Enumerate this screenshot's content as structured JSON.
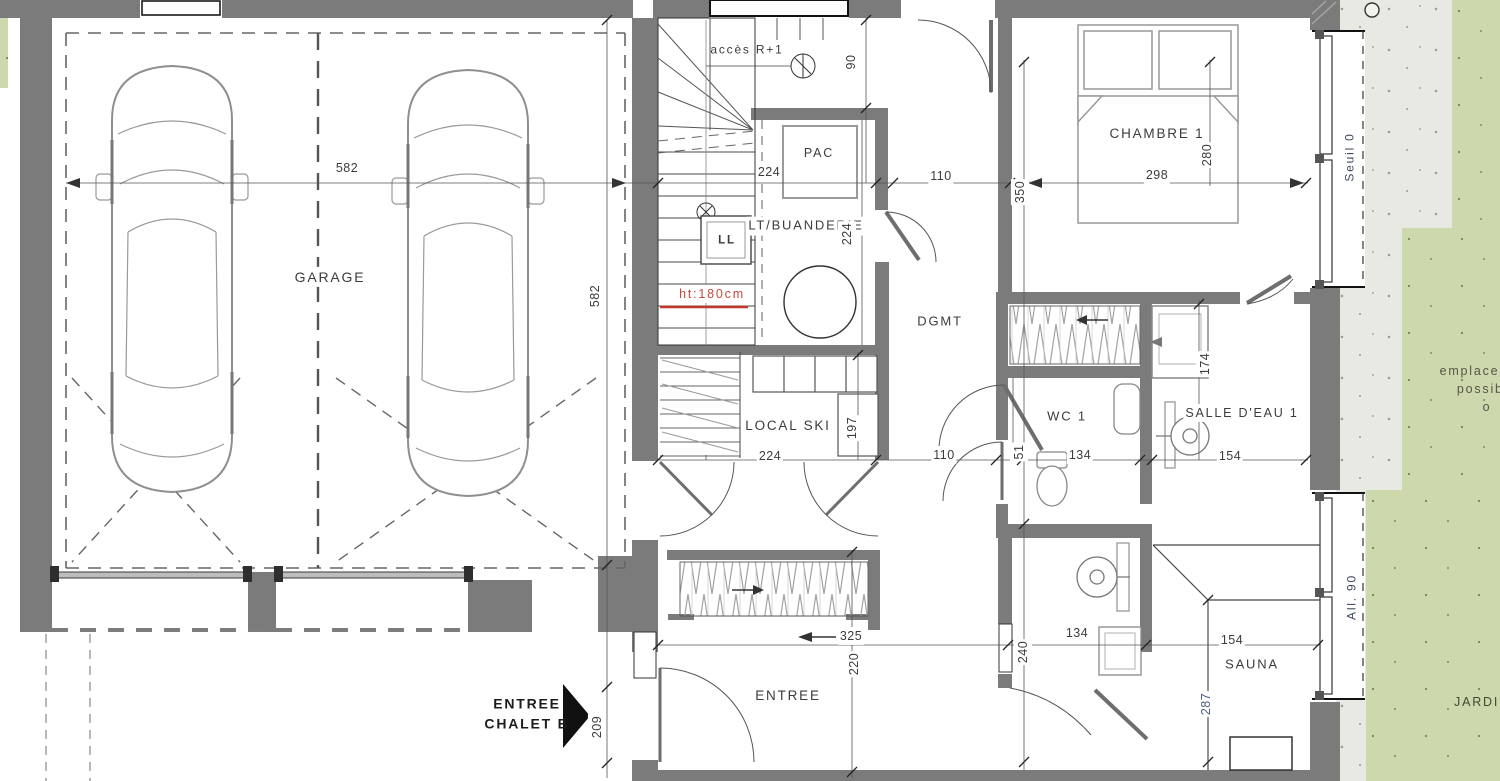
{
  "plan_title": "Chalet B - niveau garage",
  "colors": {
    "wall": "#7b7b7b",
    "green_jardin": "#cdd9ac",
    "gravel": "#e9e9e4",
    "red_note": "#c44a3d",
    "dim_text": "#3a3a3a",
    "window_label": "#3f4a5e"
  },
  "rooms": [
    {
      "name": "room-label-garage",
      "text": "GARAGE",
      "x": 330,
      "y": 277,
      "size": 14
    },
    {
      "name": "room-label-acces-r1",
      "text": "accès R+1",
      "x": 747,
      "y": 50,
      "size": 12,
      "cls": "nobg"
    },
    {
      "name": "room-label-pac",
      "text": "PAC",
      "x": 819,
      "y": 153,
      "size": 12.5,
      "cls": "nobg"
    },
    {
      "name": "room-label-lt-buanderie",
      "text": "LT/BUANDERIE",
      "x": 806,
      "y": 226,
      "size": 13
    },
    {
      "name": "room-label-ll",
      "text": "LL",
      "x": 727,
      "y": 241,
      "size": 11.5,
      "weight": 700,
      "cls": "nobg"
    },
    {
      "name": "note-ht180",
      "text": "ht:180cm",
      "x": 712,
      "y": 294,
      "size": 12.5,
      "color": "#c44a3d"
    },
    {
      "name": "room-label-dgmt",
      "text": "DGMT",
      "x": 940,
      "y": 322,
      "size": 13
    },
    {
      "name": "room-label-local-ski",
      "text": "LOCAL SKI",
      "x": 788,
      "y": 426,
      "size": 13.5
    },
    {
      "name": "room-label-wc1",
      "text": "WC 1",
      "x": 1067,
      "y": 417,
      "size": 13
    },
    {
      "name": "room-label-salle-deau-1",
      "text": "SALLE D'EAU 1",
      "x": 1242,
      "y": 413,
      "size": 12.5
    },
    {
      "name": "room-label-chambre-1",
      "text": "CHAMBRE 1",
      "x": 1157,
      "y": 134,
      "size": 13.5
    },
    {
      "name": "room-label-sauna",
      "text": "SAUNA",
      "x": 1252,
      "y": 665,
      "size": 13
    },
    {
      "name": "room-label-entree",
      "text": "ENTREE",
      "x": 788,
      "y": 696,
      "size": 13.5
    },
    {
      "name": "label-entree-chalet-b",
      "text": "ENTREE\nCHALET B",
      "x": 527,
      "y": 714,
      "size": 14,
      "weight": 700,
      "color": "#1c1c1c",
      "cls": "nobg"
    },
    {
      "name": "label-jardin",
      "text": "JARDIN",
      "x": 1482,
      "y": 702,
      "size": 12.5,
      "color": "#3f4a35",
      "cls": "nobg"
    },
    {
      "name": "label-seuil-0",
      "text": "Seuil 0",
      "x": 1350,
      "y": 157,
      "rot": -90,
      "size": 12,
      "color": "#3f4a5e",
      "cls": "nobg"
    },
    {
      "name": "label-all-90",
      "text": "All. 90",
      "x": 1352,
      "y": 597,
      "rot": -90,
      "size": 12,
      "color": "#3f4a5e",
      "cls": "nobg"
    },
    {
      "name": "label-emplacement-possible",
      "text": "emplacement\npossible\no",
      "x": 1487,
      "y": 389,
      "size": 12.5,
      "color": "#55554a",
      "cls": "nobg"
    }
  ],
  "dimensions": [
    {
      "name": "dim-garage-width",
      "text": "582",
      "x": 347,
      "y": 168
    },
    {
      "name": "dim-garage-depth",
      "text": "582",
      "x": 595,
      "y": 296,
      "rot": -90
    },
    {
      "name": "dim-stair-width-top",
      "text": "224",
      "x": 769,
      "y": 172
    },
    {
      "name": "dim-hall-width-top",
      "text": "110",
      "x": 941,
      "y": 176
    },
    {
      "name": "dim-chambre-width",
      "text": "298",
      "x": 1157,
      "y": 175
    },
    {
      "name": "dim-90",
      "text": "90",
      "x": 851,
      "y": 62,
      "rot": -90
    },
    {
      "name": "dim-350",
      "text": "350",
      "x": 1020,
      "y": 192,
      "rot": -90
    },
    {
      "name": "dim-280",
      "text": "280",
      "x": 1207,
      "y": 155,
      "rot": -90
    },
    {
      "name": "dim-buanderie-depth",
      "text": "224",
      "x": 847,
      "y": 234,
      "rot": -90
    },
    {
      "name": "dim-ski-width",
      "text": "224",
      "x": 770,
      "y": 456
    },
    {
      "name": "dim-197",
      "text": "197",
      "x": 852,
      "y": 428,
      "rot": -90
    },
    {
      "name": "dim-hall-width-low",
      "text": "110",
      "x": 944,
      "y": 455
    },
    {
      "name": "dim-51",
      "text": "51",
      "x": 1019,
      "y": 452,
      "rot": -90
    },
    {
      "name": "dim-wc-width",
      "text": "134",
      "x": 1080,
      "y": 455
    },
    {
      "name": "dim-sde-width",
      "text": "154",
      "x": 1230,
      "y": 456
    },
    {
      "name": "dim-174",
      "text": "174",
      "x": 1205,
      "y": 364,
      "rot": -90
    },
    {
      "name": "dim-325",
      "text": "325",
      "x": 851,
      "y": 636
    },
    {
      "name": "dim-220",
      "text": "220",
      "x": 854,
      "y": 664,
      "rot": -90
    },
    {
      "name": "dim-209",
      "text": "209",
      "x": 597,
      "y": 727,
      "rot": -90
    },
    {
      "name": "dim-240",
      "text": "240",
      "x": 1023,
      "y": 652,
      "rot": -90
    },
    {
      "name": "dim-134-low",
      "text": "134",
      "x": 1077,
      "y": 633
    },
    {
      "name": "dim-154-low",
      "text": "154",
      "x": 1232,
      "y": 640
    },
    {
      "name": "dim-287",
      "text": "287",
      "x": 1206,
      "y": 704,
      "rot": -90,
      "color": "#4d5d85"
    }
  ]
}
